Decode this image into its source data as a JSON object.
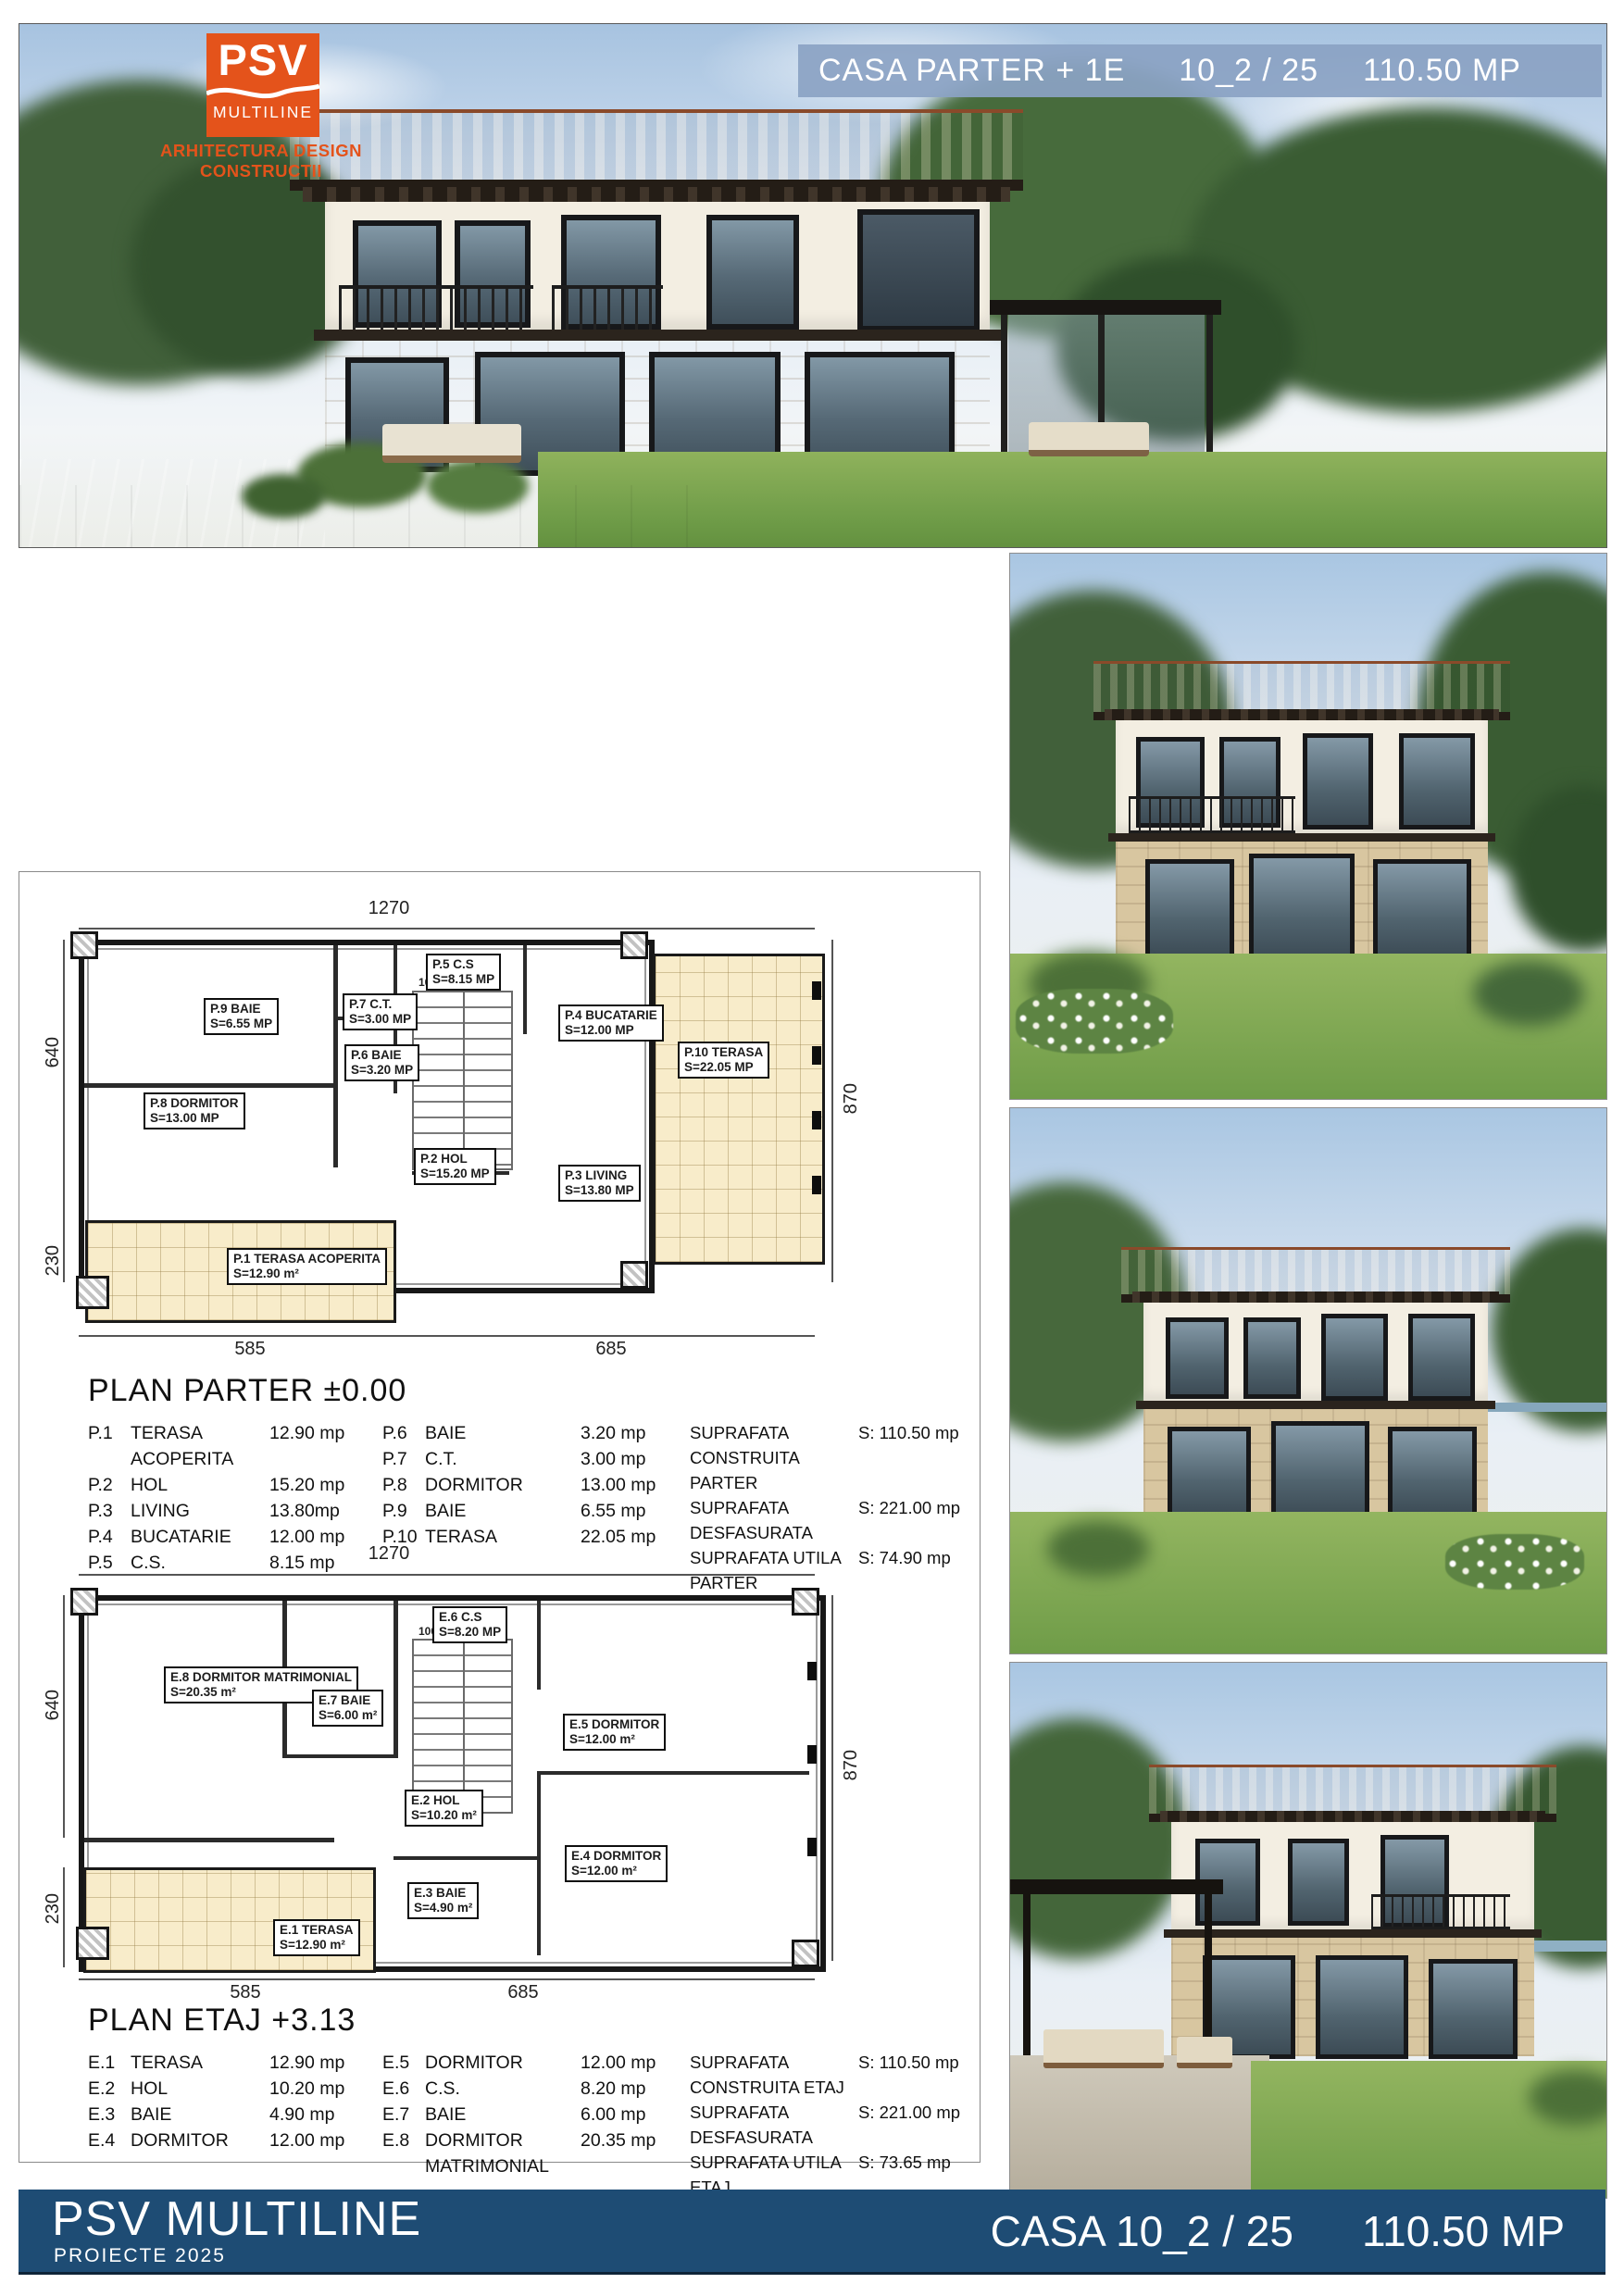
{
  "header": {
    "logo_psv": "PSV",
    "logo_multiline": "MULTILINE",
    "logo_tagline": "ARHITECTURA DESIGN CONSTRUCTII",
    "title": "CASA  PARTER + 1E",
    "code": "10_2 / 25",
    "area": "110.50 MP"
  },
  "colors": {
    "accent_orange": "#e4531b",
    "header_bar_blue": "#8ba2c4",
    "footer_navy": "#1e4c74",
    "terrace_beige": "#f8ecca"
  },
  "plan_parter": {
    "title": "PLAN  PARTER ±0.00",
    "dims": {
      "top": "1270",
      "left_upper": "640",
      "left_lower": "230",
      "right": "870",
      "bottom_left": "585",
      "bottom_right": "685",
      "stair_a": "100",
      "stair_b": "100"
    },
    "rooms": {
      "p1": {
        "name": "P.1 TERASA ACOPERITA",
        "area": "S=12.90 m²"
      },
      "p2": {
        "name": "P.2 HOL",
        "area": "S=15.20 MP"
      },
      "p3": {
        "name": "P.3 LIVING",
        "area": "S=13.80 MP"
      },
      "p4": {
        "name": "P.4 BUCATARIE",
        "area": "S=12.00 MP"
      },
      "p5": {
        "name": "P.5 C.S",
        "area": "S=8.15 MP"
      },
      "p6": {
        "name": "P.6 BAIE",
        "area": "S=3.20 MP"
      },
      "p7": {
        "name": "P.7 C.T.",
        "area": "S=3.00 MP"
      },
      "p8": {
        "name": "P.8 DORMITOR",
        "area": "S=13.00 MP"
      },
      "p9": {
        "name": "P.9 BAIE",
        "area": "S=6.55 MP"
      },
      "p10": {
        "name": "P.10 TERASA",
        "area": "S=22.05 MP"
      }
    },
    "legend_left": [
      {
        "id": "P.1",
        "name": "TERASA ACOPERITA",
        "value": "12.90 mp"
      },
      {
        "id": "P.2",
        "name": "HOL",
        "value": "15.20 mp"
      },
      {
        "id": "P.3",
        "name": "LIVING",
        "value": "13.80mp"
      },
      {
        "id": "P.4",
        "name": "BUCATARIE",
        "value": "12.00 mp"
      },
      {
        "id": "P.5",
        "name": "C.S.",
        "value": "8.15 mp"
      }
    ],
    "legend_right": [
      {
        "id": "P.6",
        "name": "BAIE",
        "value": "3.20 mp"
      },
      {
        "id": "P.7",
        "name": "C.T.",
        "value": "3.00 mp"
      },
      {
        "id": "P.8",
        "name": "DORMITOR",
        "value": "13.00 mp"
      },
      {
        "id": "P.9",
        "name": "BAIE",
        "value": "6.55 mp"
      },
      {
        "id": "P.10",
        "name": "TERASA",
        "value": "22.05 mp"
      }
    ],
    "surfaces": [
      {
        "label": "SUPRAFATA CONSTRUITA PARTER",
        "value": "S: 110.50 mp"
      },
      {
        "label": "SUPRAFATA DESFASURATA",
        "value": "S: 221.00 mp"
      },
      {
        "label": "SUPRAFATA UTILA PARTER",
        "value": "S: 74.90  mp"
      }
    ]
  },
  "plan_etaj": {
    "title": "PLAN  ETAJ +3.13",
    "dims": {
      "top": "1270",
      "left_upper": "640",
      "left_lower": "230",
      "right": "870",
      "bottom_left": "585",
      "bottom_right": "685",
      "stair_a": "100",
      "stair_b": "100"
    },
    "rooms": {
      "e1": {
        "name": "E.1 TERASA",
        "area": "S=12.90 m²"
      },
      "e2": {
        "name": "E.2 HOL",
        "area": "S=10.20 m²"
      },
      "e3": {
        "name": "E.3 BAIE",
        "area": "S=4.90 m²"
      },
      "e4": {
        "name": "E.4 DORMITOR",
        "area": "S=12.00 m²"
      },
      "e5": {
        "name": "E.5 DORMITOR",
        "area": "S=12.00 m²"
      },
      "e6": {
        "name": "E.6 C.S",
        "area": "S=8.20 MP"
      },
      "e7": {
        "name": "E.7 BAIE",
        "area": "S=6.00 m²"
      },
      "e8": {
        "name": "E.8 DORMITOR MATRIMONIAL",
        "area": "S=20.35 m²"
      }
    },
    "legend_left": [
      {
        "id": "E.1",
        "name": "TERASA",
        "value": "12.90 mp"
      },
      {
        "id": "E.2",
        "name": "HOL",
        "value": "10.20 mp"
      },
      {
        "id": "E.3",
        "name": "BAIE",
        "value": "4.90 mp"
      },
      {
        "id": "E.4",
        "name": "DORMITOR",
        "value": "12.00 mp"
      }
    ],
    "legend_right": [
      {
        "id": "E.5",
        "name": "DORMITOR",
        "value": "12.00 mp"
      },
      {
        "id": "E.6",
        "name": "C.S.",
        "value": "8.20 mp"
      },
      {
        "id": "E.7",
        "name": "BAIE",
        "value": "6.00 mp"
      },
      {
        "id": "E.8",
        "name": "DORMITOR MATRIMONIAL",
        "value": "20.35 mp"
      }
    ],
    "surfaces": [
      {
        "label": "SUPRAFATA CONSTRUITA ETAJ",
        "value": "S: 110.50 mp"
      },
      {
        "label": "SUPRAFATA DESFASURATA",
        "value": "S: 221.00 mp"
      },
      {
        "label": "SUPRAFATA UTILA ETAJ",
        "value": "S: 73.65  mp"
      }
    ]
  },
  "footer": {
    "brand": "PSV MULTILINE",
    "sub": "PROIECTE  2025",
    "casa": "CASA  10_2 / 25",
    "area": "110.50 MP"
  }
}
